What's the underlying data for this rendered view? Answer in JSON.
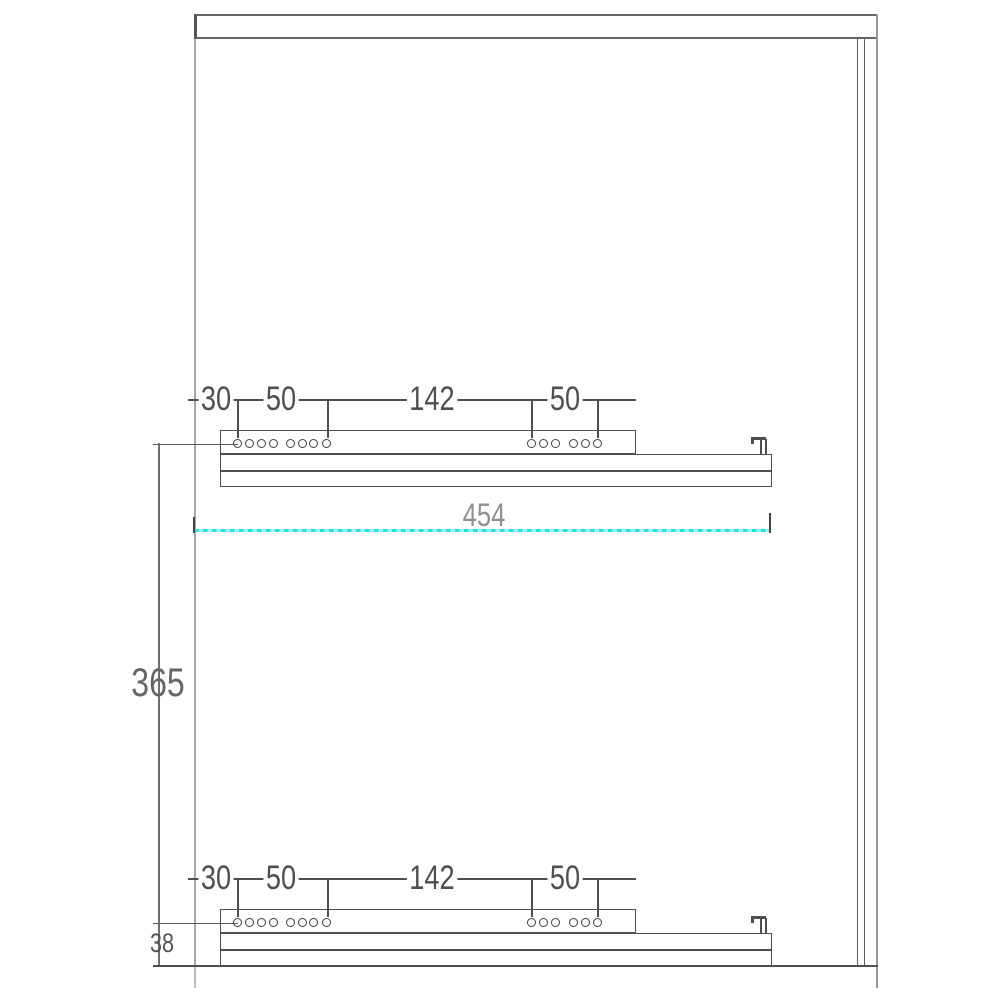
{
  "drawing": {
    "type": "technical-drawing",
    "subject": "cabinet-side-panel-with-drawer-slides",
    "colors": {
      "line_dark": "#4f4f4f",
      "line_light": "#a8a8a8",
      "highlight_cyan": "#21e3e3",
      "label_gray": "#8f8f8f"
    }
  },
  "dimensions": {
    "rail_labels": [
      "30",
      "50",
      "142",
      "50"
    ],
    "width": "454",
    "height": "365",
    "bottom_offset": "38"
  },
  "geometry": {
    "rails": [
      {
        "name": "top-drawer-slide",
        "y": 430
      },
      {
        "name": "bottom-drawer-slide",
        "y": 909
      }
    ],
    "rail_shape": {
      "x": 220,
      "box_w": 416,
      "box_h": 24,
      "bar_w": 552,
      "bar1_h": 17,
      "bar2_h": 16,
      "hole_dy": 13.5,
      "hole_d": 9,
      "hole_xs": [
        237,
        249,
        261,
        273,
        290.5,
        302,
        313.5,
        326,
        531.5,
        543,
        555,
        573.5,
        585,
        597
      ],
      "drop_xs": [
        237,
        327,
        531,
        597
      ],
      "dim_dy": -31,
      "dim_x1": 188,
      "dim_x2": 636,
      "ext_x1": 153,
      "ext_x2": 238,
      "label_cx": [
        216,
        281,
        432,
        565
      ],
      "hook_x": 751
    }
  }
}
